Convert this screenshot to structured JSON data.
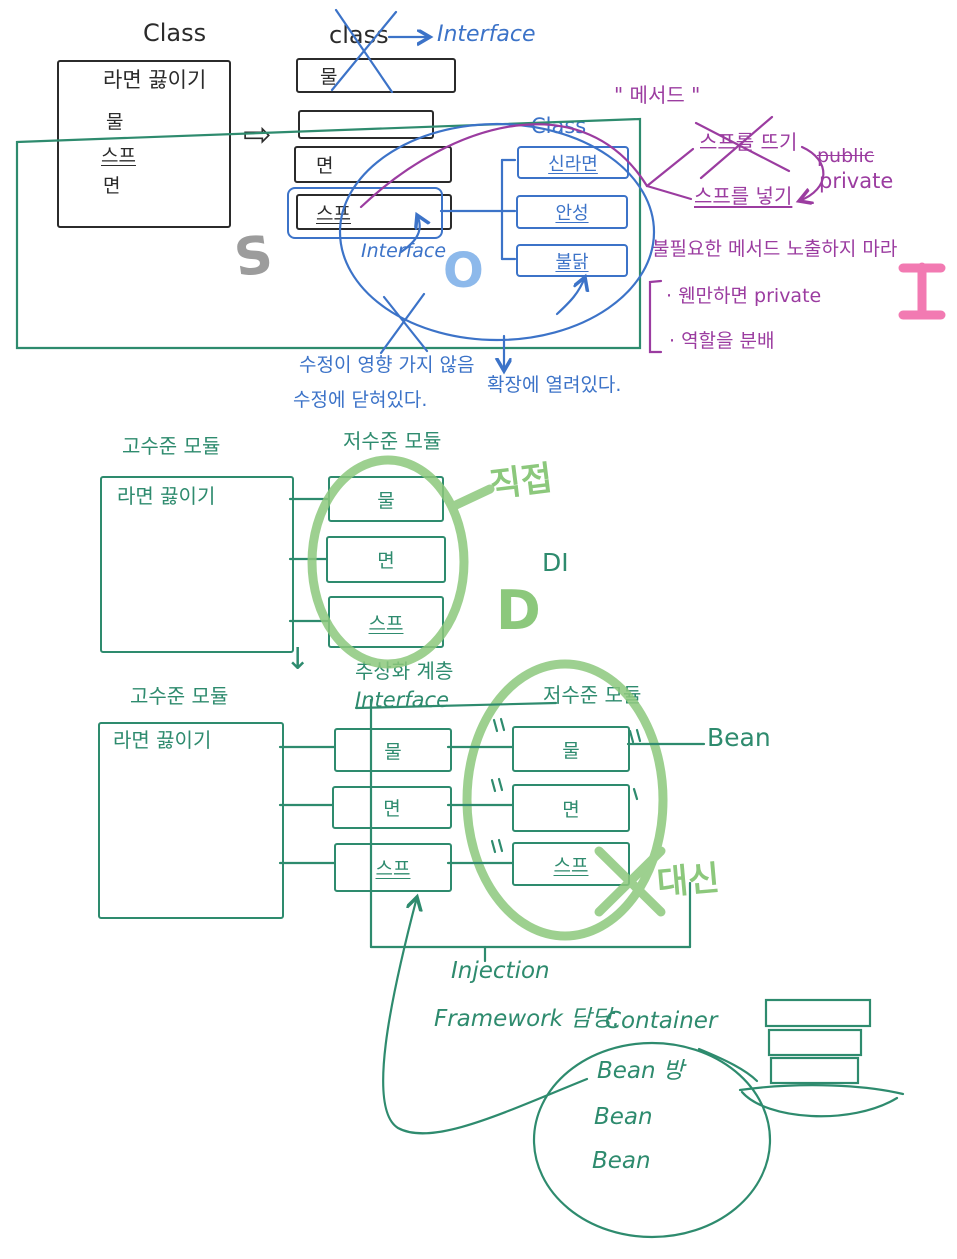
{
  "colors": {
    "ink": "#2b2b2b",
    "green_pen": "#2e8b6e",
    "marker_green": "#8cc87c",
    "blue_pen": "#3c73c8",
    "light_blue": "#8db9eb",
    "purple": "#9b3ca0",
    "pink": "#f05aa0",
    "gray": "#9c9c9c"
  },
  "icons": {
    "transform_arrow": "⇨",
    "down_arrow": "↓"
  },
  "srp": {
    "class_title": "Class",
    "ramen": "라면 끓이기",
    "ingredients": [
      "물",
      "스프",
      "면"
    ],
    "mid_title": "class",
    "interface_arrow_label": "Interface",
    "mid_boxes": [
      "물",
      "",
      "면",
      "스프"
    ],
    "interface_callout": "Interface",
    "letters": {
      "s": "S",
      "o": "O",
      "i": "I"
    },
    "impl_class_title": "Class",
    "impl_boxes": [
      "신라면",
      "안성",
      "불닭"
    ],
    "method_quote": "\" 메서드 \"",
    "method_removed": "스프를 뜨기",
    "method_kept": "스프를 넣기",
    "access_public": "public",
    "access_private": "private",
    "isp_rule": "불필요한 메서드 노출하지 마라",
    "isp_bullet1": "· 웬만하면 private",
    "isp_bullet2": "· 역할을 분배",
    "ocp_note1": "수정이 영향 가지 않음",
    "ocp_note2": "수정에 닫혀있다.",
    "ocp_note3": "확장에 열려있다."
  },
  "dip_before": {
    "high_label": "고수준 모듈",
    "high_box": "라면 끓이기",
    "low_label": "저수준 모듈",
    "low_boxes": [
      "물",
      "면",
      "스프"
    ],
    "direct_label": "직접",
    "di_label": "DI",
    "d_letter": "D"
  },
  "dip_after": {
    "abstraction_label": "추상화 계층",
    "interface_label": "Interface",
    "high_label": "고수준 모듈",
    "high_box": "라면 끓이기",
    "iface_boxes": [
      "물",
      "면",
      "스프"
    ],
    "low_label": "저수준 모듈",
    "low_boxes": [
      "물",
      "면",
      "스프"
    ],
    "bean_label": "Bean",
    "instead_label": "대신"
  },
  "container": {
    "injection": "Injection",
    "framework": "Framework 담당.",
    "container_label": "Container",
    "beans": [
      "Bean 방",
      "Bean",
      "Bean"
    ]
  }
}
